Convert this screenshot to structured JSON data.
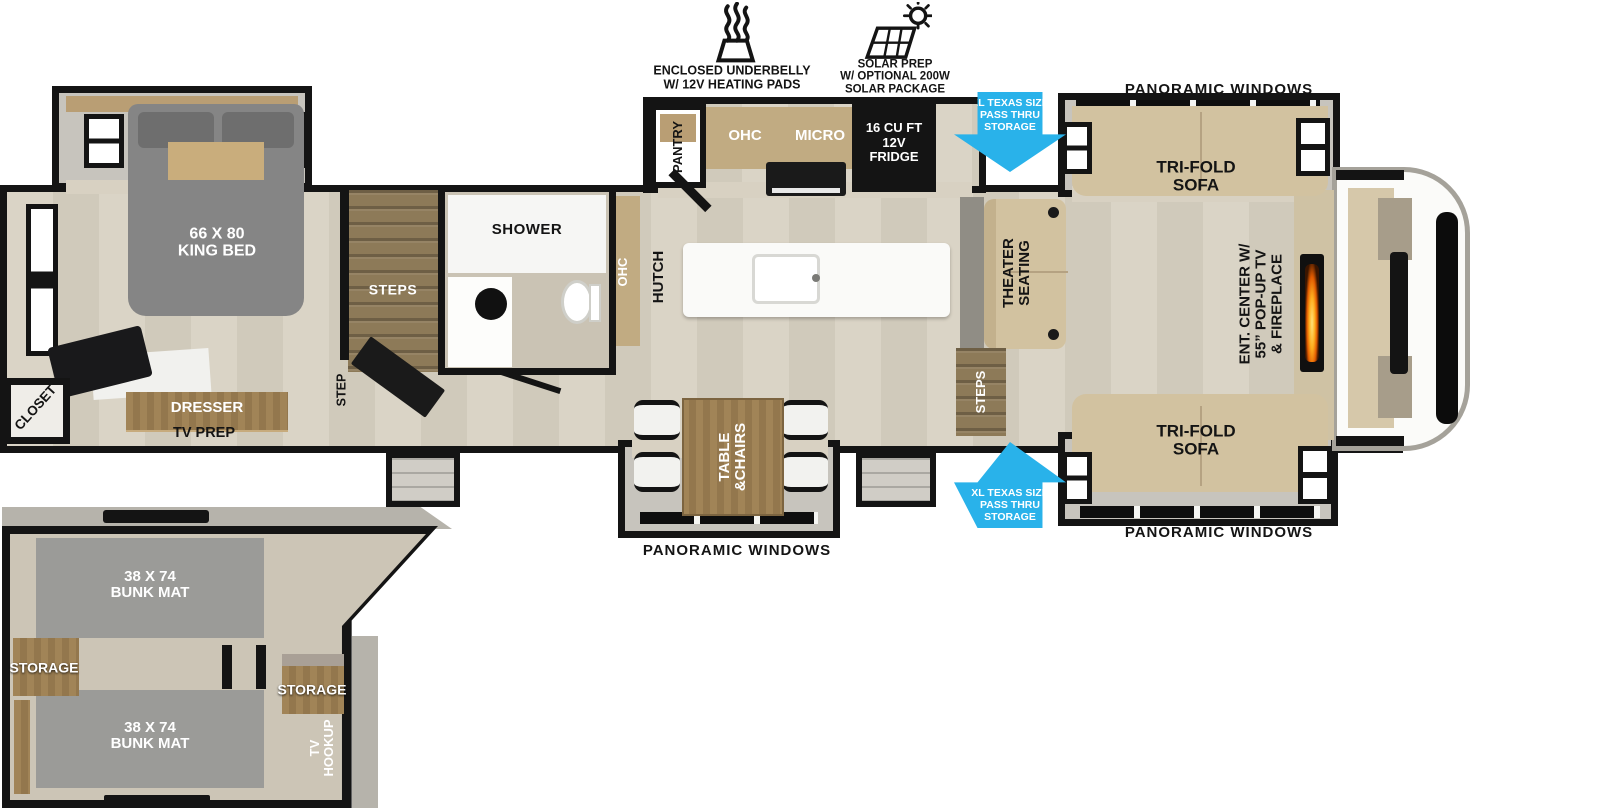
{
  "features": {
    "underbelly_lines": [
      "ENCLOSED UNDERBELLY",
      "W/ 12V HEATING PADS"
    ],
    "solar_lines": [
      "SOLAR PREP",
      "W/ OPTIONAL 200W",
      "SOLAR PACKAGE"
    ]
  },
  "callouts": {
    "panoramic_top": "PANORAMIC WINDOWS",
    "panoramic_bottom_right": "PANORAMIC WINDOWS",
    "panoramic_bottom_mid": "PANORAMIC WINDOWS",
    "pass_thru_lines": [
      "XL TEXAS SIZE",
      "PASS THRU",
      "STORAGE"
    ]
  },
  "bedroom": {
    "bed_lines": [
      "66 X 80",
      "KING BED"
    ],
    "closet": "CLOSET",
    "dresser": "DRESSER",
    "tv_prep": "TV PREP",
    "step": "STEP",
    "steps": "STEPS"
  },
  "bath": {
    "shower": "SHOWER",
    "ohc": "OHC"
  },
  "kitchen": {
    "pantry": "PANTRY",
    "ohc": "OHC",
    "micro": "MICRO",
    "fridge_lines": [
      "16 CU FT",
      "12V",
      "FRIDGE"
    ],
    "hutch": "HUTCH"
  },
  "living": {
    "theater_lines": [
      "THEATER",
      "SEATING"
    ],
    "steps": "STEPS",
    "sofa_top_lines": [
      "TRI-FOLD",
      "SOFA"
    ],
    "sofa_bottom_lines": [
      "TRI-FOLD",
      "SOFA"
    ],
    "ent_lines": [
      "ENT. CENTER W/",
      "55” POP-UP TV",
      "& FIREPLACE"
    ],
    "table_lines": [
      "TABLE",
      "&CHAIRS"
    ]
  },
  "bunk": {
    "mat_top_lines": [
      "38 X 74",
      "BUNK MAT"
    ],
    "mat_bottom_lines": [
      "38 X 74",
      "BUNK MAT"
    ],
    "storage_left": "STORAGE",
    "storage_right": "STORAGE",
    "tv_hookup_lines": [
      "TV",
      "HOOKUP"
    ]
  },
  "colors": {
    "arrow_blue": "#29b2ea",
    "wall_black": "#141414",
    "floor_tan": "#d8d1c2",
    "sofa_tan": "#d2c2a0",
    "wood_brown": "#a18457",
    "slide_gray": "#c7c4bd",
    "mat_gray": "#9b9b98",
    "bed_gray": "#858585"
  }
}
